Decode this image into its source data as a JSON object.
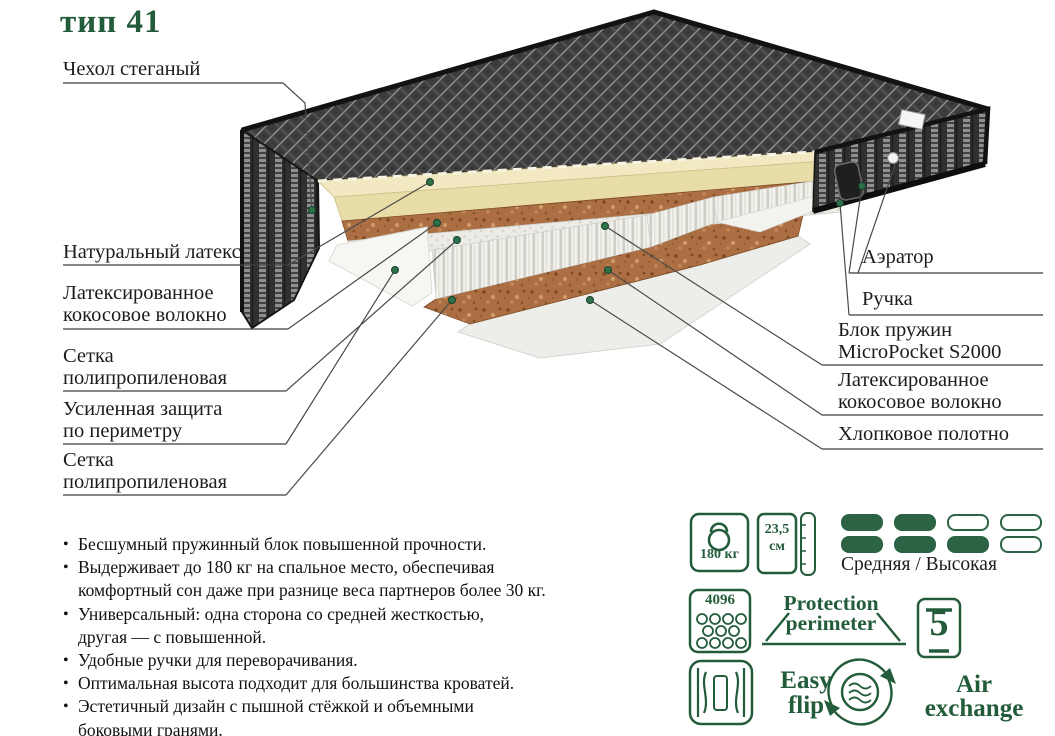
{
  "title": "тип 41",
  "colors": {
    "accent_green": "#235c3b",
    "pill_green": "#2d6345",
    "text_black": "#1c1c1c",
    "leader_line": "#4a4a4a",
    "cover_dark": "#3d3d3d",
    "latex_cream": "#f2e9c2",
    "coco_brown": "#ac6f44"
  },
  "diagram": {
    "labels_left": [
      {
        "text": "Чехол стеганый"
      },
      {
        "text": "Натуральный латекс"
      },
      {
        "text": "Латексированное\nкокосовое волокно"
      },
      {
        "text": "Сетка\nполипропиленовая"
      },
      {
        "text": "Усиленная защита\nпо периметру"
      },
      {
        "text": "Сетка\nполипропиленовая"
      }
    ],
    "labels_right": [
      {
        "text": "Аэратор"
      },
      {
        "text": "Ручка"
      },
      {
        "text": "Блок пружин\nMicroPocket S2000"
      },
      {
        "text": "Латексированное\nкокосовое волокно"
      },
      {
        "text": "Хлопковое полотно"
      }
    ]
  },
  "bullets": [
    "Бесшумный пружинный блок повышенной прочности.",
    "Выдерживает до 180 кг на спальное место, обеспечивая\nкомфортный сон даже при разнице веса партнеров более 30 кг.",
    "Универсальный: одна сторона со средней жесткостью,\nдругая — с повышенной.",
    "Удобные ручки для переворачивания.",
    "Оптимальная высота подходит для большинства кроватей.",
    "Эстетичный дизайн с пышной стёжкой и объемными\nбоковыми гранями."
  ],
  "features": {
    "weight": {
      "value": "180 кг"
    },
    "height": {
      "value": "23,5\nсм"
    },
    "firmness": {
      "label": "Средняя / Высокая",
      "pills": [
        [
          "filled",
          "filled",
          "empty",
          "empty"
        ],
        [
          "filled",
          "filled",
          "filled",
          "empty"
        ]
      ]
    },
    "springs": {
      "count": "4096"
    },
    "protection": {
      "text": "Protection\nperimeter"
    },
    "zones": {
      "value": "5"
    },
    "easy_flip": {
      "text": "Easy\nflip"
    },
    "air": {
      "text": "Air\nexchange"
    }
  }
}
